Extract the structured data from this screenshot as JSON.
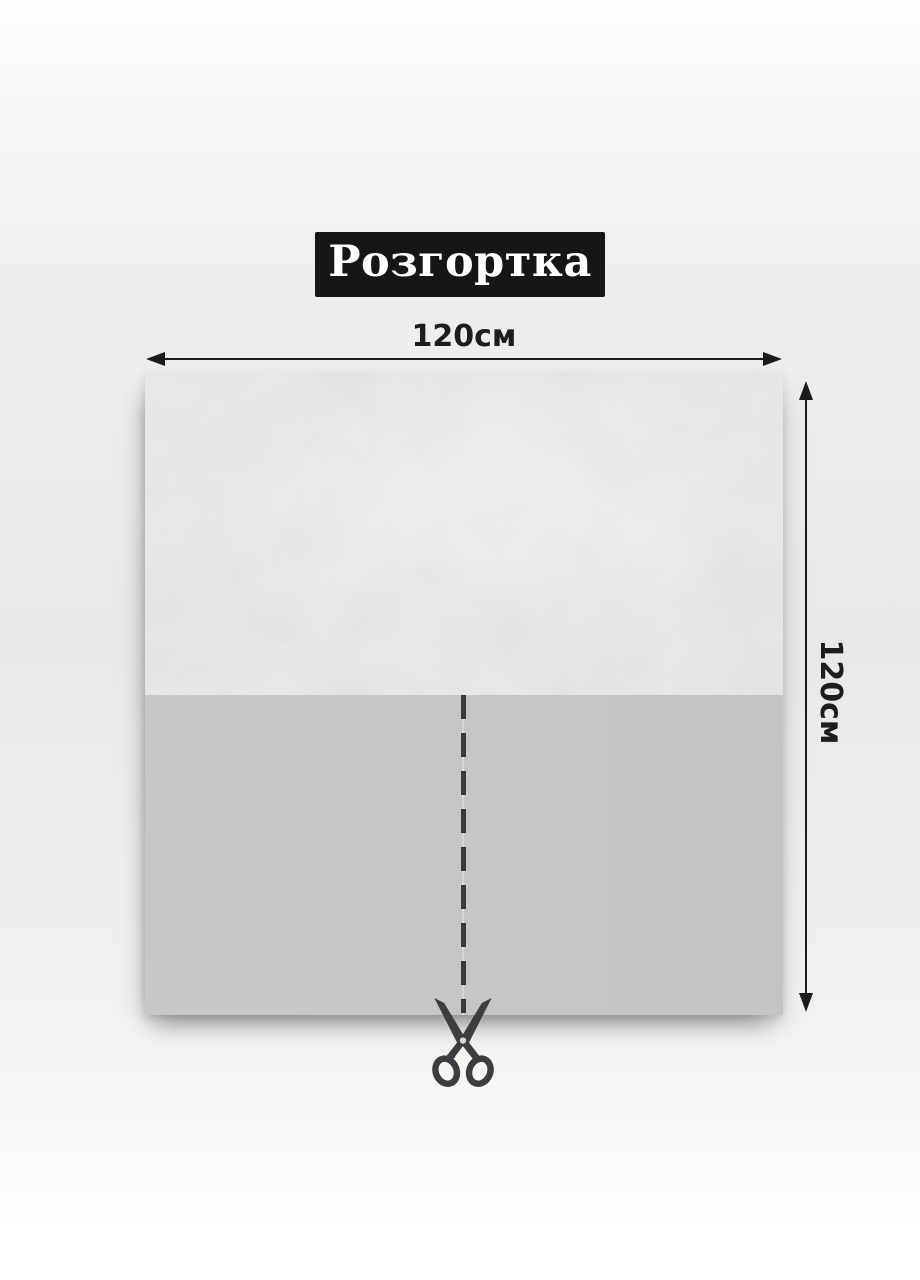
{
  "title": {
    "label": "Розгортка",
    "background_color": "#161616",
    "text_color": "#ffffff"
  },
  "dimensions": {
    "width": {
      "label": "120см"
    },
    "height": {
      "label": "120см"
    },
    "arrow_color": "#1c1c1c"
  },
  "panel": {
    "top_half": {
      "description": "textured light-gray fabric",
      "base_color": "#e9e9e8"
    },
    "bottom_half": {
      "description": "plain gray fabric",
      "color": "#c6c6c6"
    },
    "cut_line": {
      "color": "#3a3a3a",
      "style": "dashed-vertical"
    }
  },
  "icons": {
    "scissors": {
      "name": "scissors-icon",
      "color": "#3a3e41"
    }
  }
}
